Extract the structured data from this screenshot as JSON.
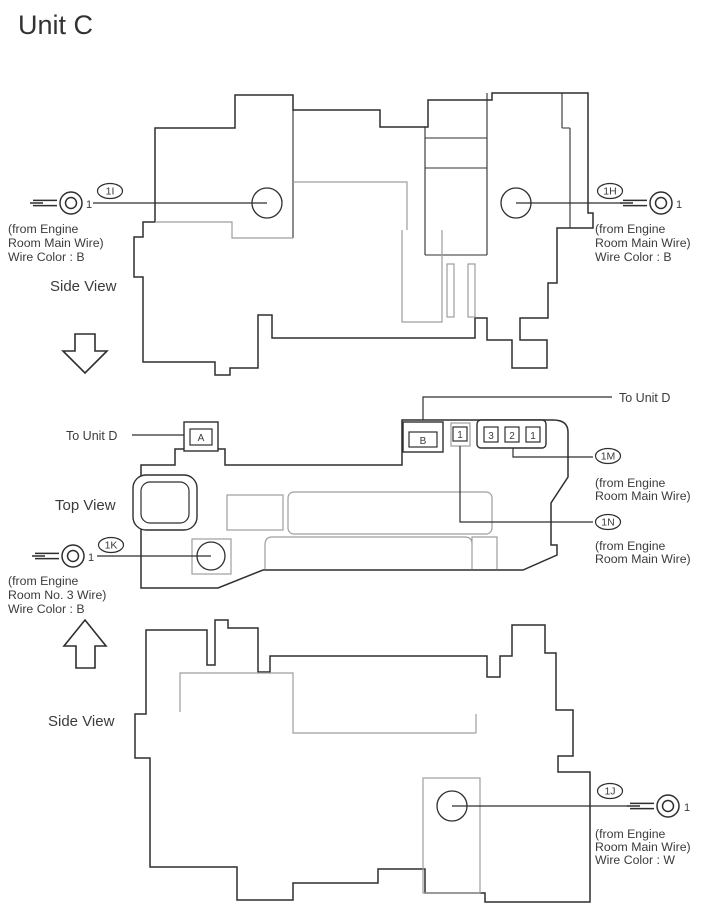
{
  "title": "Unit C",
  "view_labels": {
    "side_view_top": "Side View",
    "top_view": "Top View",
    "side_view_bottom": "Side View"
  },
  "links": {
    "to_unit_d_left": "To Unit D",
    "to_unit_d_right": "To Unit D"
  },
  "terminals": {
    "t1i": {
      "id": "1I",
      "pin": "1",
      "notes": [
        "(from Engine",
        "Room Main Wire)",
        "Wire Color : B"
      ]
    },
    "t1h": {
      "id": "1H",
      "pin": "1",
      "notes": [
        "(from Engine",
        "Room Main Wire)",
        "Wire Color : B"
      ]
    },
    "t1k": {
      "id": "1K",
      "pin": "1",
      "notes": [
        "(from Engine",
        "Room No. 3 Wire)",
        "Wire Color : B"
      ]
    },
    "t1m": {
      "id": "1M",
      "notes": [
        "(from Engine",
        "Room Main Wire)"
      ]
    },
    "t1n": {
      "id": "1N",
      "notes": [
        "(from Engine",
        "Room Main Wire)"
      ]
    },
    "t1j": {
      "id": "1J",
      "pin": "1",
      "notes": [
        "(from Engine",
        "Room Main Wire)",
        "Wire Color : W"
      ]
    }
  },
  "inline_connectors": {
    "a": "A",
    "b": "B",
    "single": "1",
    "triple": [
      "3",
      "2",
      "1"
    ]
  },
  "colors": {
    "outline": "#2f2f2f",
    "inner_line": "#9e9e9e",
    "text": "#3b3b3b",
    "background": "#ffffff"
  }
}
